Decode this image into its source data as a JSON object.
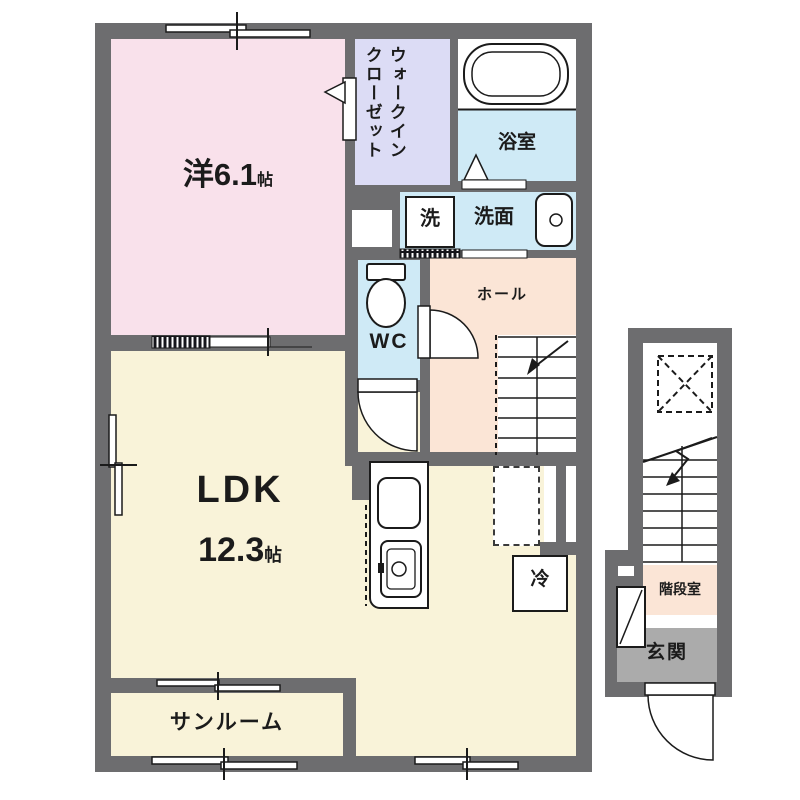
{
  "plan_title": "2F apartment floor plan",
  "colors": {
    "wall": "#6d6d6f",
    "western_room": "#f9e1eb",
    "closet": "#dcdcf5",
    "wet_area_blue": "#cfeaf6",
    "hall_peach": "#fbe5d6",
    "ldk_cream": "#f9f3d9",
    "entrance_gray": "#ababab",
    "line": "#1b1b1b"
  },
  "rooms": {
    "western": {
      "name": "洋",
      "area": "6.1",
      "unit": "帖"
    },
    "wic": {
      "line1": "ウォークイン",
      "line2": "クローゼット"
    },
    "bath": {
      "label": "浴室"
    },
    "laundry": {
      "label": "洗"
    },
    "washroom": {
      "label": "洗面"
    },
    "wc": {
      "label": "WC"
    },
    "hall": {
      "label": "ホール"
    },
    "ldk": {
      "name": "LDK",
      "area": "12.3",
      "unit": "帖"
    },
    "fridge": {
      "label": "冷"
    },
    "sunroom": {
      "label": "サンルーム"
    },
    "stairwell": {
      "label": "階段室"
    },
    "entrance": {
      "label": "玄関"
    }
  }
}
